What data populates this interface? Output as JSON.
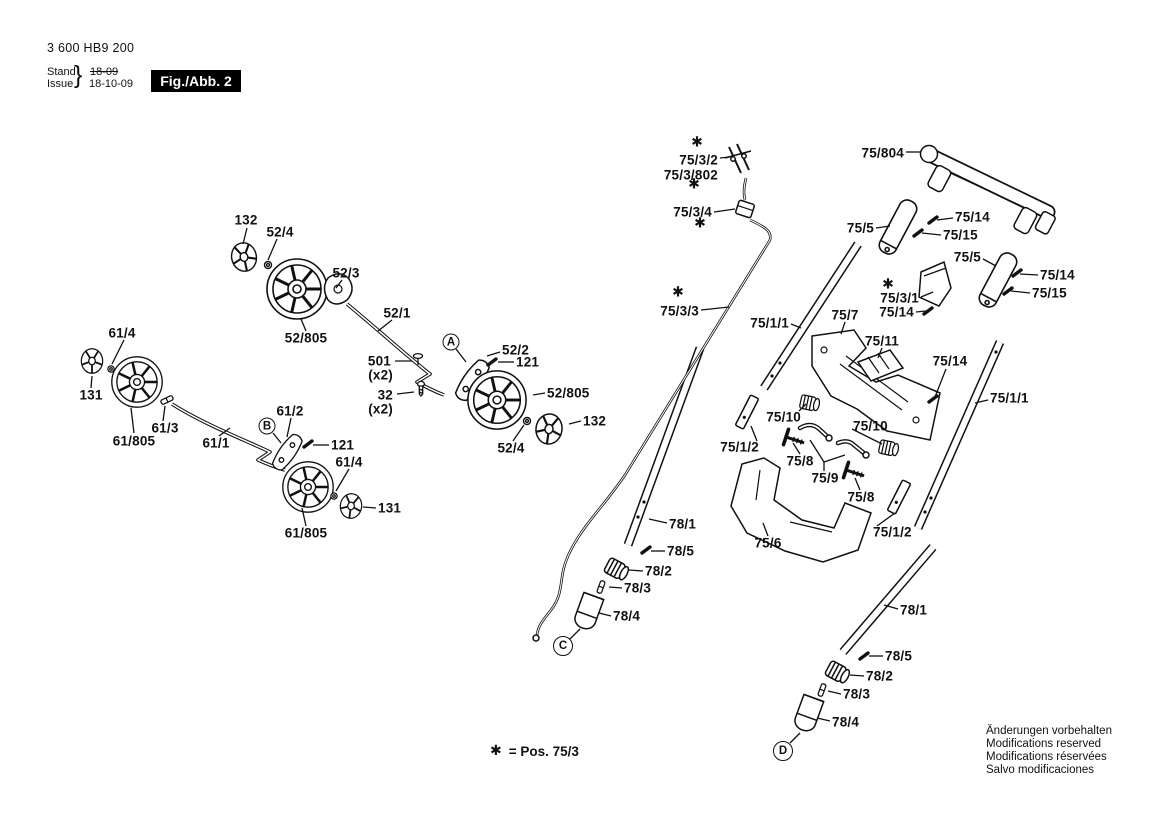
{
  "header": {
    "part_number": "3 600 HB9 200",
    "stand_label": "Stand",
    "issue_label": "Issue",
    "brace": "}",
    "stand_value": "18-09",
    "issue_value": "18-10-09",
    "figure_label": "Fig./Abb. 2"
  },
  "legend": {
    "star": "✱",
    "text": "= Pos. 75/3"
  },
  "notices": [
    "Änderungen vorbehalten",
    "Modifications reserved",
    "Modifications réservées",
    "Salvo modificaciones"
  ],
  "colors": {
    "ink": "#111111",
    "paper": "#ffffff",
    "figure_box_bg": "#000000",
    "figure_box_text": "#ffffff"
  },
  "diagram": {
    "star_glyph": "✱",
    "labels": [
      {
        "t": "132",
        "x": 246,
        "y": 220,
        "a": "m"
      },
      {
        "t": "52/4",
        "x": 280,
        "y": 232,
        "a": "m"
      },
      {
        "t": "52/3",
        "x": 346,
        "y": 273,
        "a": "m"
      },
      {
        "t": "52/1",
        "x": 397,
        "y": 313,
        "a": "m"
      },
      {
        "t": "52/805",
        "x": 306,
        "y": 338,
        "a": "m"
      },
      {
        "t": "61/4",
        "x": 122,
        "y": 333,
        "a": "m"
      },
      {
        "t": "131",
        "x": 91,
        "y": 395,
        "a": "m"
      },
      {
        "t": "61/805",
        "x": 134,
        "y": 441,
        "a": "m"
      },
      {
        "t": "61/3",
        "x": 165,
        "y": 428,
        "a": "m"
      },
      {
        "t": "61/1",
        "x": 216,
        "y": 443,
        "a": "m"
      },
      {
        "t": "501",
        "x": 391,
        "y": 361,
        "a": "e"
      },
      {
        "t": "(x2)",
        "x": 393,
        "y": 375,
        "a": "e"
      },
      {
        "t": "32",
        "x": 393,
        "y": 395,
        "a": "e"
      },
      {
        "t": "(x2)",
        "x": 393,
        "y": 409,
        "a": "e"
      },
      {
        "t": "52/2",
        "x": 502,
        "y": 350,
        "a": "s"
      },
      {
        "t": "121",
        "x": 516,
        "y": 362,
        "a": "s"
      },
      {
        "t": "52/805",
        "x": 547,
        "y": 393,
        "a": "s"
      },
      {
        "t": "132",
        "x": 583,
        "y": 421,
        "a": "s"
      },
      {
        "t": "52/4",
        "x": 511,
        "y": 448,
        "a": "m"
      },
      {
        "t": "61/2",
        "x": 290,
        "y": 411,
        "a": "m"
      },
      {
        "t": "121",
        "x": 331,
        "y": 445,
        "a": "s"
      },
      {
        "t": "61/4",
        "x": 349,
        "y": 462,
        "a": "m"
      },
      {
        "t": "131",
        "x": 378,
        "y": 508,
        "a": "s"
      },
      {
        "t": "61/805",
        "x": 306,
        "y": 533,
        "a": "m"
      },
      {
        "t": "75/3/2",
        "x": 718,
        "y": 160,
        "a": "e"
      },
      {
        "t": "75/3/802",
        "x": 718,
        "y": 175,
        "a": "e"
      },
      {
        "t": "75/3/4",
        "x": 712,
        "y": 212,
        "a": "e"
      },
      {
        "t": "75/804",
        "x": 904,
        "y": 153,
        "a": "e"
      },
      {
        "t": "75/5",
        "x": 874,
        "y": 228,
        "a": "e"
      },
      {
        "t": "75/14",
        "x": 955,
        "y": 217,
        "a": "s"
      },
      {
        "t": "75/15",
        "x": 943,
        "y": 235,
        "a": "s"
      },
      {
        "t": "75/5",
        "x": 981,
        "y": 257,
        "a": "e"
      },
      {
        "t": "75/14",
        "x": 1040,
        "y": 275,
        "a": "s"
      },
      {
        "t": "75/15",
        "x": 1032,
        "y": 293,
        "a": "s"
      },
      {
        "t": "75/3/1",
        "x": 919,
        "y": 298,
        "a": "e"
      },
      {
        "t": "75/14",
        "x": 914,
        "y": 312,
        "a": "e"
      },
      {
        "t": "75/3/3",
        "x": 699,
        "y": 311,
        "a": "e"
      },
      {
        "t": "75/1/1",
        "x": 789,
        "y": 323,
        "a": "e"
      },
      {
        "t": "75/7",
        "x": 845,
        "y": 315,
        "a": "m"
      },
      {
        "t": "75/11",
        "x": 882,
        "y": 341,
        "a": "m"
      },
      {
        "t": "75/14",
        "x": 950,
        "y": 361,
        "a": "m"
      },
      {
        "t": "75/1/1",
        "x": 990,
        "y": 398,
        "a": "s"
      },
      {
        "t": "75/10",
        "x": 801,
        "y": 417,
        "a": "e"
      },
      {
        "t": "75/1/2",
        "x": 759,
        "y": 447,
        "a": "e"
      },
      {
        "t": "75/8",
        "x": 800,
        "y": 461,
        "a": "m"
      },
      {
        "t": "75/9",
        "x": 825,
        "y": 478,
        "a": "m"
      },
      {
        "t": "75/10",
        "x": 853,
        "y": 426,
        "a": "s"
      },
      {
        "t": "75/8",
        "x": 861,
        "y": 497,
        "a": "m"
      },
      {
        "t": "75/6",
        "x": 768,
        "y": 543,
        "a": "m"
      },
      {
        "t": "75/1/2",
        "x": 873,
        "y": 532,
        "a": "s"
      },
      {
        "t": "78/1",
        "x": 669,
        "y": 524,
        "a": "s"
      },
      {
        "t": "78/5",
        "x": 667,
        "y": 551,
        "a": "s"
      },
      {
        "t": "78/2",
        "x": 645,
        "y": 571,
        "a": "s"
      },
      {
        "t": "78/3",
        "x": 624,
        "y": 588,
        "a": "s"
      },
      {
        "t": "78/4",
        "x": 613,
        "y": 616,
        "a": "s"
      },
      {
        "t": "78/1",
        "x": 900,
        "y": 610,
        "a": "s"
      },
      {
        "t": "78/5",
        "x": 885,
        "y": 656,
        "a": "s"
      },
      {
        "t": "78/2",
        "x": 866,
        "y": 676,
        "a": "s"
      },
      {
        "t": "78/3",
        "x": 843,
        "y": 694,
        "a": "s"
      },
      {
        "t": "78/4",
        "x": 832,
        "y": 722,
        "a": "s"
      }
    ],
    "stars": [
      {
        "x": 697,
        "y": 143
      },
      {
        "x": 694,
        "y": 185
      },
      {
        "x": 700,
        "y": 224
      },
      {
        "x": 678,
        "y": 293
      },
      {
        "x": 888,
        "y": 285
      }
    ],
    "refs": [
      {
        "t": "A",
        "x": 451,
        "y": 342,
        "d": 17
      },
      {
        "t": "B",
        "x": 267,
        "y": 426,
        "d": 17
      },
      {
        "t": "C",
        "x": 563,
        "y": 646,
        "d": 20
      },
      {
        "t": "D",
        "x": 783,
        "y": 751,
        "d": 20
      }
    ],
    "leaders": [
      [
        247,
        228,
        243,
        244
      ],
      [
        277,
        239,
        268,
        260
      ],
      [
        342,
        280,
        336,
        288
      ],
      [
        392,
        320,
        378,
        331
      ],
      [
        306,
        331,
        301,
        319
      ],
      [
        124,
        340,
        112,
        364
      ],
      [
        91,
        388,
        92,
        376
      ],
      [
        134,
        433,
        131,
        408
      ],
      [
        163,
        421,
        165,
        406
      ],
      [
        219,
        436,
        230,
        428
      ],
      [
        395,
        361,
        412,
        361
      ],
      [
        397,
        394,
        414,
        392
      ],
      [
        456,
        349,
        466,
        362
      ],
      [
        500,
        352,
        487,
        356
      ],
      [
        514,
        362,
        498,
        362
      ],
      [
        545,
        393,
        533,
        395
      ],
      [
        581,
        421,
        569,
        424
      ],
      [
        513,
        441,
        524,
        425
      ],
      [
        273,
        433,
        281,
        443
      ],
      [
        291,
        418,
        287,
        437
      ],
      [
        329,
        445,
        313,
        445
      ],
      [
        349,
        469,
        336,
        491
      ],
      [
        376,
        508,
        363,
        507
      ],
      [
        306,
        526,
        302,
        508
      ],
      [
        720,
        158,
        729,
        157
      ],
      [
        714,
        212,
        735,
        209
      ],
      [
        906,
        152,
        921,
        152
      ],
      [
        876,
        228,
        890,
        226
      ],
      [
        953,
        218,
        937,
        220
      ],
      [
        941,
        235,
        922,
        233
      ],
      [
        983,
        259,
        996,
        266
      ],
      [
        1038,
        275,
        1020,
        274
      ],
      [
        1030,
        293,
        1011,
        291
      ],
      [
        921,
        297,
        933,
        292
      ],
      [
        916,
        312,
        926,
        311
      ],
      [
        701,
        310,
        729,
        307
      ],
      [
        791,
        324,
        801,
        328
      ],
      [
        845,
        322,
        841,
        334
      ],
      [
        882,
        348,
        878,
        358
      ],
      [
        946,
        369,
        935,
        397
      ],
      [
        988,
        400,
        975,
        403
      ],
      [
        799,
        411,
        806,
        404
      ],
      [
        757,
        441,
        751,
        426
      ],
      [
        800,
        454,
        793,
        443
      ],
      [
        852,
        429,
        882,
        444
      ],
      [
        860,
        490,
        855,
        478
      ],
      [
        768,
        536,
        763,
        523
      ],
      [
        877,
        526,
        895,
        513
      ],
      [
        824,
        471,
        824,
        462
      ],
      [
        824,
        462,
        810,
        440
      ],
      [
        824,
        462,
        845,
        455
      ],
      [
        667,
        523,
        649,
        519
      ],
      [
        665,
        551,
        651,
        551
      ],
      [
        643,
        571,
        629,
        570
      ],
      [
        622,
        588,
        609,
        587
      ],
      [
        611,
        616,
        599,
        613
      ],
      [
        570,
        639,
        580,
        629
      ],
      [
        898,
        609,
        884,
        605
      ],
      [
        883,
        656,
        869,
        656
      ],
      [
        864,
        676,
        850,
        675
      ],
      [
        841,
        694,
        828,
        691
      ],
      [
        830,
        721,
        817,
        718
      ],
      [
        790,
        743,
        800,
        733
      ]
    ],
    "pins": [
      [
        933,
        220
      ],
      [
        918,
        233
      ],
      [
        1017,
        273
      ],
      [
        1008,
        291
      ],
      [
        928,
        311
      ],
      [
        933,
        399
      ],
      [
        492,
        362
      ],
      [
        308,
        444
      ],
      [
        646,
        550
      ],
      [
        864,
        656
      ]
    ]
  }
}
